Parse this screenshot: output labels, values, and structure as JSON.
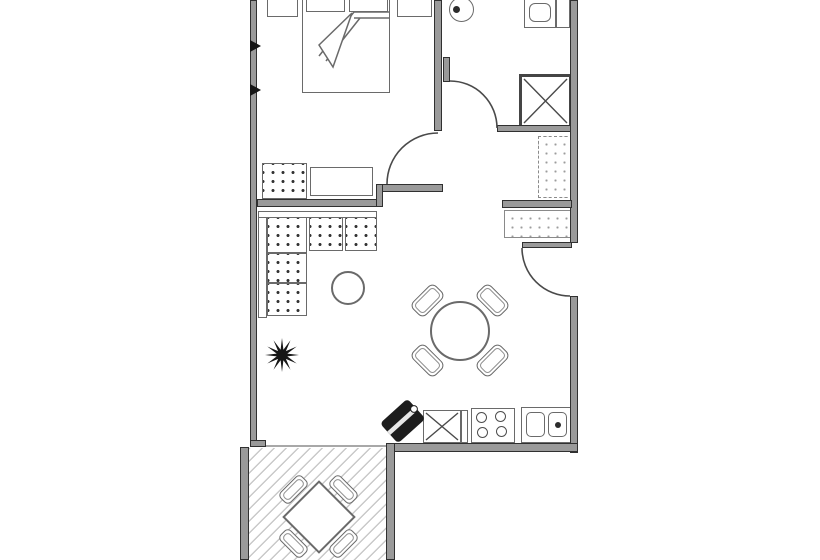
{
  "plan": {
    "label": "One-bedroom apartment floor plan with terrace",
    "type": "architectural-floor-plan",
    "visible_text": [],
    "palette": {
      "background": "#ffffff",
      "wall_fill": "#9a9a9a",
      "wall_edge": "#303030",
      "furniture_line": "#6a6a6a",
      "sofa_dot": "#333333",
      "terrace_hatch": "#c9c9c9",
      "dark_appliance": "#1d1d1d"
    },
    "rooms": [
      {
        "name": "bedroom",
        "position": "top-left"
      },
      {
        "name": "bathroom",
        "position": "top-right"
      },
      {
        "name": "hallway",
        "position": "middle-right"
      },
      {
        "name": "living-dining-room",
        "position": "center"
      },
      {
        "name": "kitchen",
        "position": "bottom-center"
      },
      {
        "name": "terrace",
        "position": "bottom-left",
        "floor": "diagonal-hatch"
      }
    ],
    "fixtures": {
      "bedroom": [
        "double-bed",
        "two-pillows",
        "folded-blanket",
        "nightstand-left",
        "nightstand-right",
        "bench",
        "armchair"
      ],
      "bathroom": [
        "round-washbasin",
        "toilet",
        "shower-with-x"
      ],
      "hallway": [
        "wardrobe",
        "sideboard"
      ],
      "living_room": [
        "l-shaped-sofa-5-cushions",
        "round-coffee-table",
        "potted-plant",
        "round-dining-table",
        "four-dining-chairs"
      ],
      "kitchen": [
        "dark-corner-appliance",
        "cabinet-with-x",
        "four-burner-hob",
        "double-basin-sink"
      ],
      "terrace": [
        "square-table-rotated",
        "four-chairs"
      ]
    },
    "doors": [
      {
        "name": "bedroom-door",
        "swing": "quarter-arc"
      },
      {
        "name": "bathroom-door",
        "swing": "quarter-arc"
      },
      {
        "name": "entrance-door",
        "wall": "right",
        "swing": "quarter-arc"
      }
    ],
    "windows": [
      {
        "name": "bedroom-window-ticks",
        "wall": "left",
        "count": 2
      },
      {
        "name": "terrace-glass-front",
        "wall": "bottom-of-living-room"
      }
    ]
  }
}
